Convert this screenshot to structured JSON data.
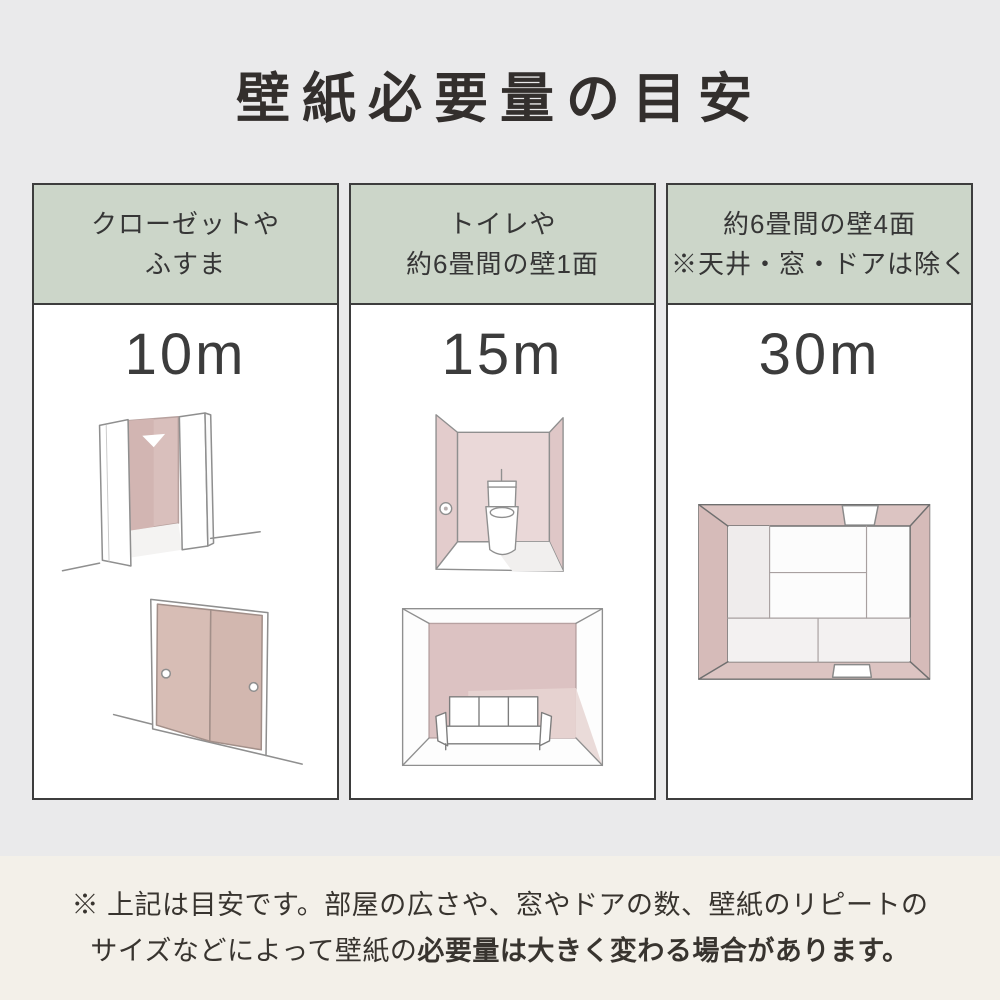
{
  "page": {
    "title": "壁紙必要量の目安"
  },
  "columns": [
    {
      "header": [
        "クローゼットや",
        "ふすま"
      ],
      "amount": "10m",
      "illustrations": [
        "open-closet",
        "fusuma-sliding-doors"
      ]
    },
    {
      "header": [
        "トイレや",
        "約6畳間の壁1面"
      ],
      "amount": "15m",
      "illustrations": [
        "toilet-room",
        "room-one-wall-sofa"
      ]
    },
    {
      "header": [
        "約6畳間の壁4面",
        "※天井・窓・ドアは除く"
      ],
      "amount": "30m",
      "illustrations": [
        "room-four-walls-top-view"
      ]
    }
  ],
  "footnote": {
    "line1": "※ 上記は目安です。部屋の広さや、窓やドアの数、壁紙のリピートの",
    "line2_regular": "サイズなどによって壁紙の",
    "line2_bold": "必要量は大きく変わる場合があります。"
  },
  "colors": {
    "background_top": "#eaeaeb",
    "background_bottom": "#f3f0e9",
    "header_green": "#ccd6c9",
    "column_border": "#3d3d3d",
    "wall_pink": "#dcc2c0",
    "wall_pink_light": "#ead8d8",
    "text_dark": "#332f2d"
  }
}
